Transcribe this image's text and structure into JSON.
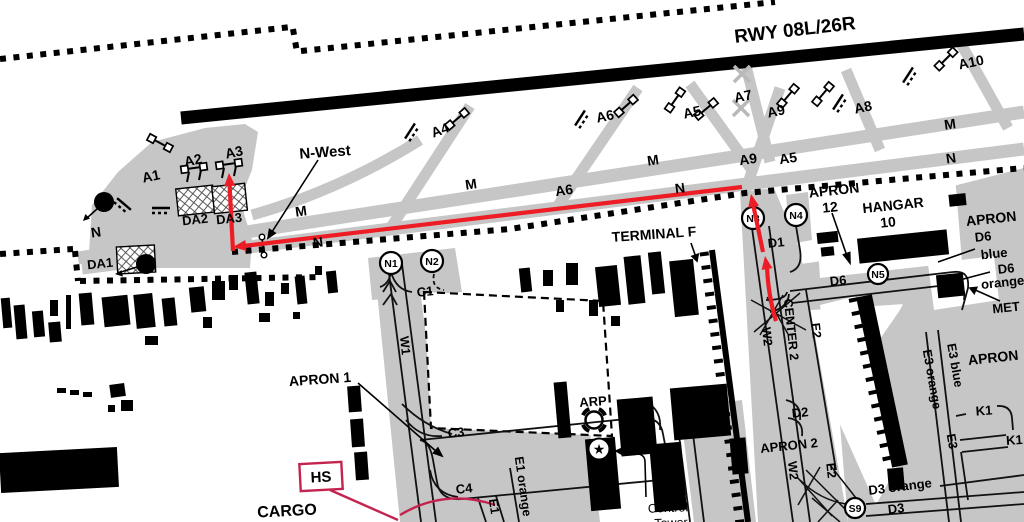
{
  "map": {
    "colors": {
      "route_red": "#ee1c25",
      "hotspot_crimson": "#c4234f",
      "taxiway_gray": "#c6c6c6"
    },
    "runway": {
      "label": "RWY 08L/26R"
    },
    "taxiways": {
      "a1": "A1",
      "a2": "A2",
      "a3": "A3",
      "a4": "A4",
      "a5": "A5",
      "a6": "A6",
      "a7": "A7",
      "a8": "A8",
      "a9": "A9",
      "a10": "A10",
      "m": "M",
      "n": "N"
    },
    "deice": {
      "da1": "DA1",
      "da2": "DA2",
      "da3": "DA3"
    },
    "hotspots": {
      "hs": "HS",
      "num1": "1",
      "num2": "2"
    },
    "nodes": {
      "n1": "N1",
      "n2": "N2",
      "n3": "N3",
      "n4": "N4",
      "n5": "N5",
      "s9": "S9"
    },
    "routes": {
      "c1": "C1",
      "c3": "C3",
      "c4": "C4",
      "w1": "W1",
      "w2": "W2",
      "e1": "E1",
      "e1_orange": "E1 orange",
      "e2": "E2",
      "e3": "E3",
      "e3_blue": "E3 blue",
      "e3_orange": "E3 orange",
      "d1": "D1",
      "d2": "D2",
      "d3": "D3",
      "d3_orange": "D3 orange",
      "d6": "D6",
      "blue": "blue",
      "orange": "orange",
      "k1": "K1",
      "center2": "CENTER 2"
    },
    "areas": {
      "apron": "APRON",
      "apron1": "APRON 1",
      "apron2": "APRON 2",
      "apron12_num": "12",
      "hangar": "HANGAR",
      "hangar_num": "10",
      "terminal_f": "TERMINAL F",
      "tml": "TML",
      "tml_num": "2",
      "cargo": "CARGO",
      "met": "MET",
      "arp": "ARP",
      "n_west": "N-West",
      "control_1": "Control",
      "control_2": "Tower"
    },
    "icons": {
      "tower_star": "★"
    }
  }
}
